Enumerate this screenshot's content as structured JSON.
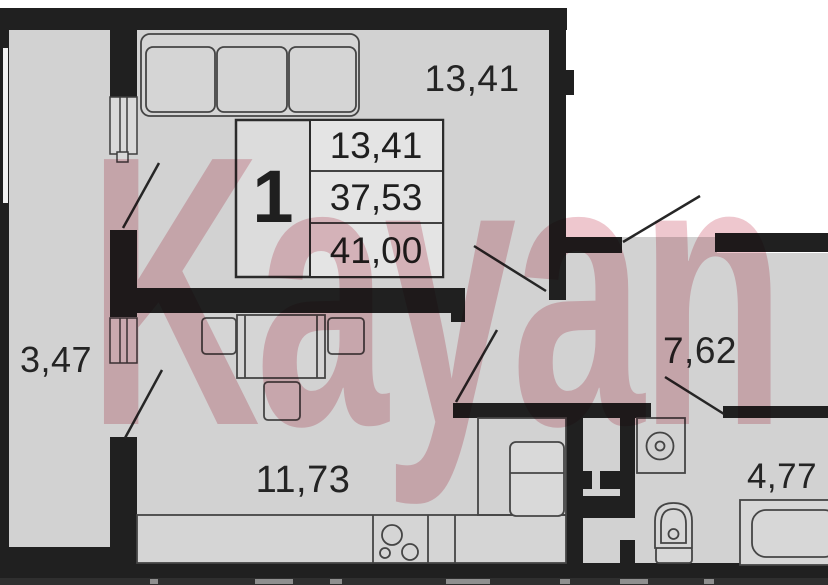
{
  "watermark": {
    "text": "Kayan"
  },
  "info_box": {
    "rooms_count": "1",
    "living_area": "13,41",
    "area_no_balcony": "37,53",
    "total_area": "41,00"
  },
  "room_labels": {
    "living_room": "13,41",
    "balcony": "3,47",
    "kitchen": "11,73",
    "hallway": "7,62",
    "bathroom": "4,77"
  },
  "colors": {
    "wall": "#202020",
    "floor": "#d2d2d2",
    "furniture_line": "#454545",
    "info_box_bg": "#dcdcdc",
    "info_cell_bg": "#e4e4e4",
    "watermark_pink": "#eec4cc",
    "background": "#ffffff"
  }
}
